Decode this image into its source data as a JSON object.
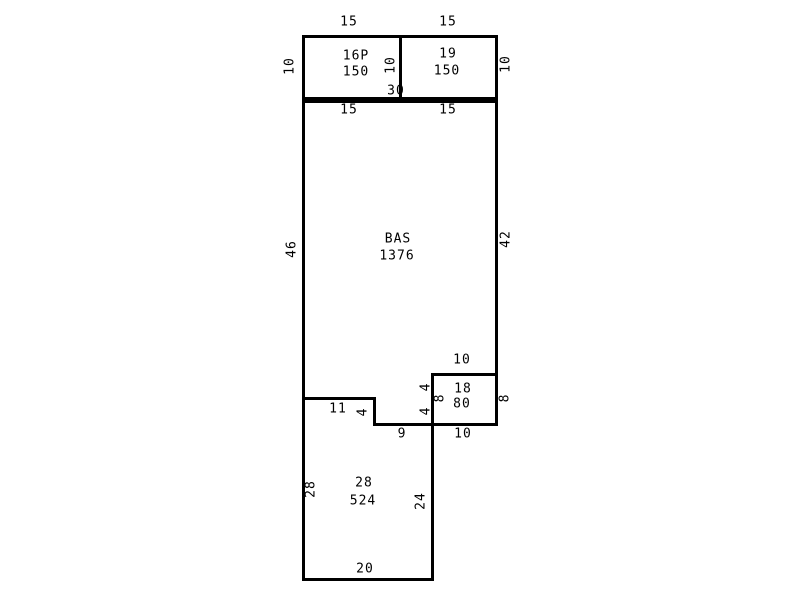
{
  "sketch": {
    "type": "floor-plan-sketch",
    "colors": {
      "line": "#000000",
      "background": "#ffffff",
      "text": "#000000"
    },
    "areas": {
      "upper_left": {
        "code": "16P",
        "area": "150"
      },
      "upper_right": {
        "code": "19",
        "area": "150"
      },
      "main": {
        "code": "BAS",
        "area": "1376"
      },
      "right_mid": {
        "code": "18",
        "area": "80"
      },
      "bottom": {
        "code": "28",
        "area": "524"
      }
    },
    "dims": {
      "top_left_width": "15",
      "top_right_width": "15",
      "upper_left_height": "10",
      "upper_divider_height": "10",
      "upper_right_height": "10",
      "upper_bottom_width": "30",
      "bas_top_left_width": "15",
      "bas_top_right_width": "15",
      "bas_left_height": "46",
      "bas_right_height": "42",
      "box18_top_width": "10",
      "box18_left_upper": "4",
      "box18_left_lower": "4",
      "box18_left_height": "8",
      "box18_right_height": "8",
      "box18_bottom_width": "10",
      "step_width": "11",
      "step_height": "4",
      "step_bottom_width": "9",
      "bottom_left_height": "28",
      "bottom_right_height": "24",
      "bottom_width": "20"
    }
  }
}
